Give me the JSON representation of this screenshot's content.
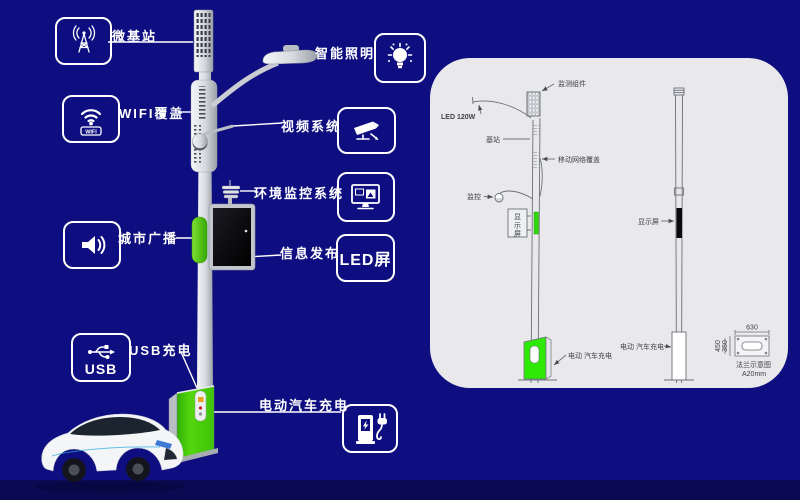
{
  "colors": {
    "background": "#0e0e80",
    "bottom_band": "#0a0a52",
    "panel": "#e9e9ec",
    "accent_green": "#3bd408",
    "callout_line": "#ffffff"
  },
  "callouts": {
    "micro_base_station": {
      "label": "微基站"
    },
    "wifi": {
      "label": "WIFI覆盖",
      "badge": "WIFI"
    },
    "city_broadcast": {
      "label": "城市广播"
    },
    "usb": {
      "label": "USB充电",
      "badge": "USB"
    },
    "smart_lighting": {
      "label": "智能照明"
    },
    "video_system": {
      "label": "视频系统"
    },
    "env_monitoring": {
      "label": "环境监控系统"
    },
    "info_publish": {
      "label": "信息发布",
      "box_text": "LED屏"
    },
    "ev_charging": {
      "label": "电动汽车充电"
    }
  },
  "diagram": {
    "monitor_component": "监测组件",
    "led_power": "LED 120W",
    "base_station": "基站",
    "mobile_network": "移动网络覆盖",
    "surveillance": "监控",
    "display_vert_1": "显",
    "display_vert_2": "示",
    "display_vert_3": "屏",
    "display_right": "显示屏",
    "ev_left": "电动 汽车充电",
    "ev_right": "电动 汽车充电",
    "dim_top": "630",
    "dim_side_outer": "450",
    "dim_side_inner": "350",
    "flange_title": "法兰示意图",
    "flange_spec": "A20mm"
  }
}
